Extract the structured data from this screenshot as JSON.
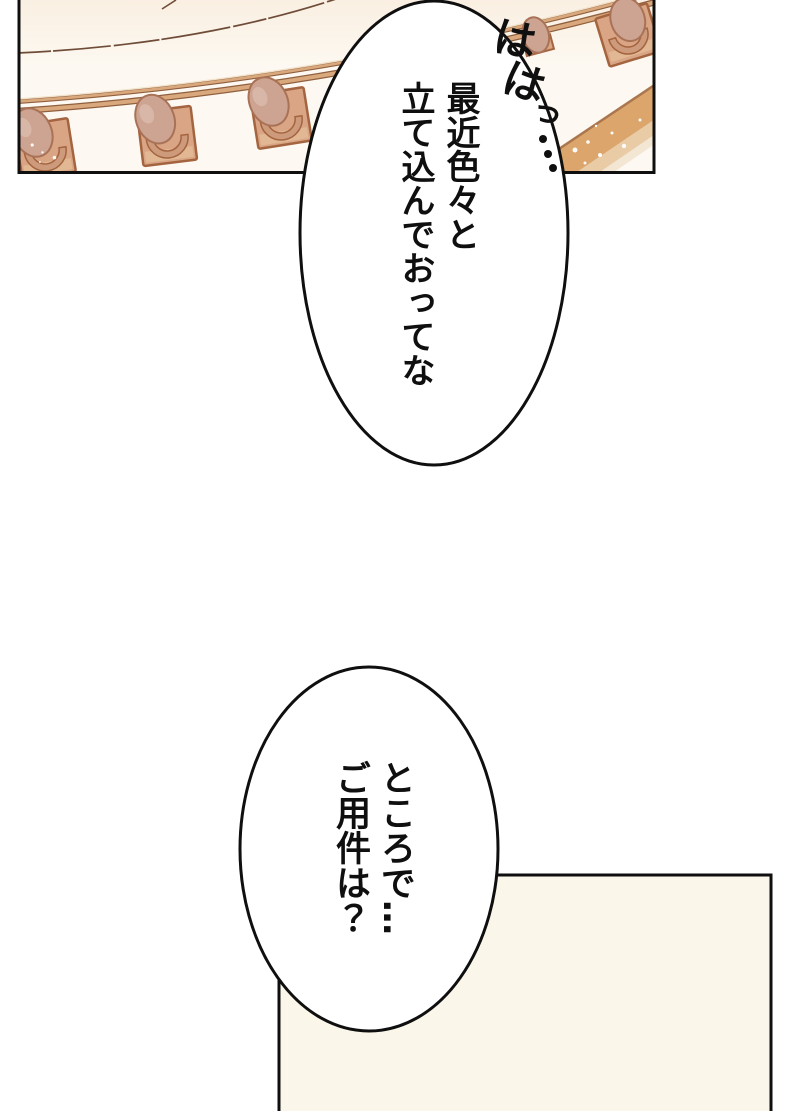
{
  "page": {
    "background": "#ffffff"
  },
  "panels": {
    "top": {
      "art": "balcony-railing-seen-from-below",
      "bg": "#fdf9f2",
      "border": "#0f0f0f",
      "rail": "#d9a87c",
      "rail_edge": "#8f5f3e",
      "plate": "#d9a584",
      "plate_edge": "#a4643f",
      "knob": "#cda391",
      "knob_edge": "#a97257",
      "band": "#dba56c"
    },
    "bottom": {
      "bg": "#fbf6ea",
      "border": "#0f0f0f"
    }
  },
  "bubbles": {
    "top": {
      "text": "最近色々と\n立て込んでおってな",
      "fill": "#ffffff",
      "stroke": "#0f0f0f"
    },
    "bottom": {
      "text": "ところで…\nご用件は？",
      "fill": "#ffffff",
      "stroke": "#0f0f0f"
    }
  },
  "sfx": {
    "laugh": {
      "full": "ははっ…",
      "glyphs": [
        "は",
        "は",
        "っ"
      ]
    }
  }
}
